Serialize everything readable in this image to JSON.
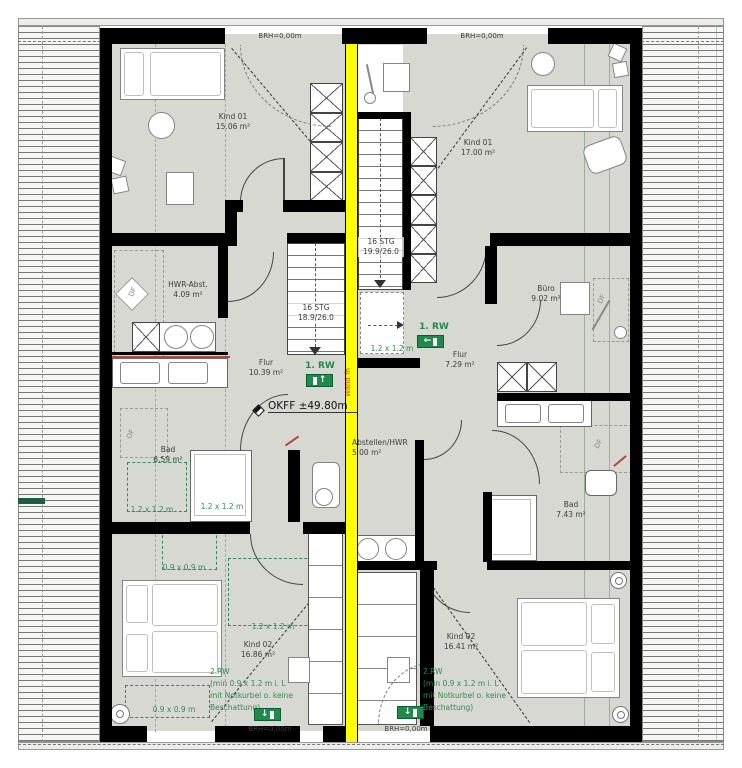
{
  "plan": {
    "unit_left": {
      "kind01": {
        "name": "Kind 01",
        "area": "15.06 m²"
      },
      "hwr_abst": {
        "name": "HWR-Abst.",
        "area": "4.09 m²"
      },
      "flur": {
        "name": "Flur",
        "area": "10.39 m²"
      },
      "bad": {
        "name": "Bad",
        "area": "6.59 m²"
      },
      "kind02": {
        "name": "Kind 02",
        "area": "16.86 m²"
      },
      "stairs": {
        "steps": "16 STG",
        "rise_run": "18.9/26.0"
      }
    },
    "unit_right": {
      "kind01": {
        "name": "Kind 01",
        "area": "17.00 m²"
      },
      "buero": {
        "name": "Büro",
        "area": "9.02 m²"
      },
      "flur": {
        "name": "Flur",
        "area": "7.29 m²"
      },
      "abstellen_hwr": {
        "name": "Abstellen/HWR",
        "area": "5.00 m²"
      },
      "bad": {
        "name": "Bad",
        "area": "7.43 m²"
      },
      "kind02": {
        "name": "Kind 02",
        "area": "16.41 m²"
      },
      "stairs": {
        "steps": "16 STG",
        "rise_run": "19.9/26.0"
      }
    },
    "annotations": {
      "level": "OKFF ±49.80m",
      "sill_height": "BRH=0,00m",
      "party_wall": "Wand fh",
      "roof_window": "DF",
      "escape1": "1. RW",
      "escape2_line1": "2.RW",
      "escape2_line2": "(min 0.9 x 1.2 m i. L",
      "escape2_line3": "mit Notkurbel o. keine",
      "escape2_line4": "Beschattung)",
      "zone_12": "1.2 x 1.2 m",
      "zone_09": "0.9 x 0.9 m",
      "icons": {
        "exit_up": "↑",
        "exit_down": "↓",
        "exit_left": "←"
      }
    },
    "colors": {
      "party_wall": "#ffff00",
      "escape_green": "#1f8a4c",
      "floor": "#d8d8d3",
      "wall": "#000000",
      "note_red": "#c0392b"
    }
  }
}
